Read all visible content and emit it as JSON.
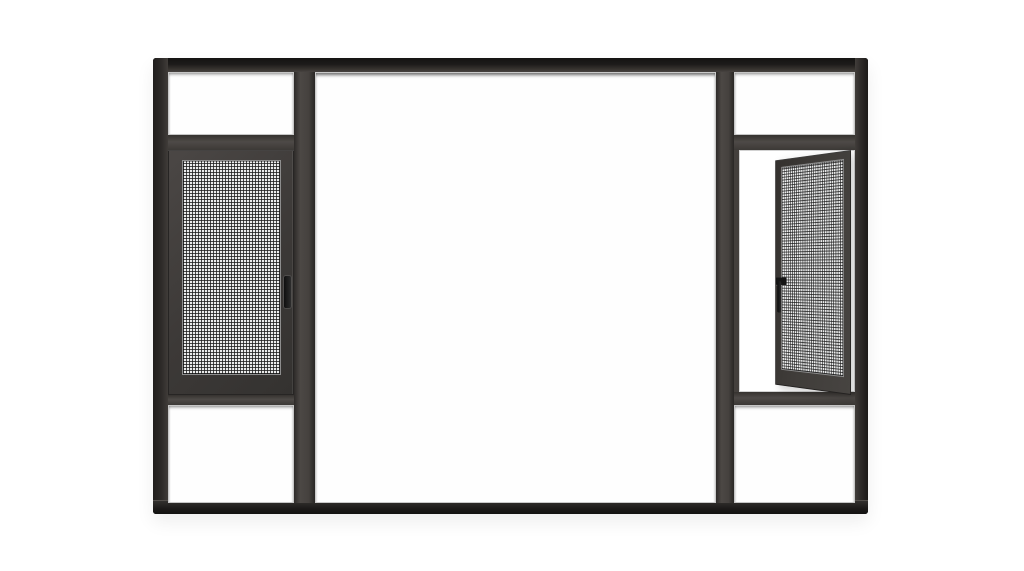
{
  "scene": {
    "description": "Product photograph of a dark charcoal aluminium window frame on a plain white background. Layout: tall left and right side columns each with a clear transom pane on top, a fly-screen sash in the middle and a clear pane at the bottom; a large fixed clear glass pane in the center. The left mesh-screen sash is closed; the right mesh-screen casement is swung open on its right hinge, shown in perspective, with a small dark handle on its free stile.",
    "background": "#ffffff"
  },
  "colors": {
    "background": "#ffffff",
    "frame_face": "#44403d",
    "frame_edge_dark": "#1a1817",
    "frame_edge_mid": "#343130",
    "frame_highlight": "#dedede",
    "sash_face": "#3e3b39",
    "sash_bevel": "#7d7d7d",
    "mesh_bg": "#ebecec",
    "mesh_line": "rgba(25,25,25,0.78)",
    "glass_edge": "#c6c6c6",
    "glass_shadow": "rgba(15,15,15,0.5)",
    "handle": "#151515"
  },
  "parts": {
    "frame": "outer aluminium frame",
    "left_transom": "left top fixed glass pane",
    "right_transom": "right top fixed glass pane",
    "center_pane": "large fixed center glass pane",
    "left_screen_sash": "closed fly-screen sash (left)",
    "right_screen_sash": "open fly-screen casement (right)",
    "left_bottom_pane": "left bottom fixed glass pane",
    "right_bottom_pane": "right bottom fixed glass pane",
    "handles": "two dark sash handles"
  }
}
